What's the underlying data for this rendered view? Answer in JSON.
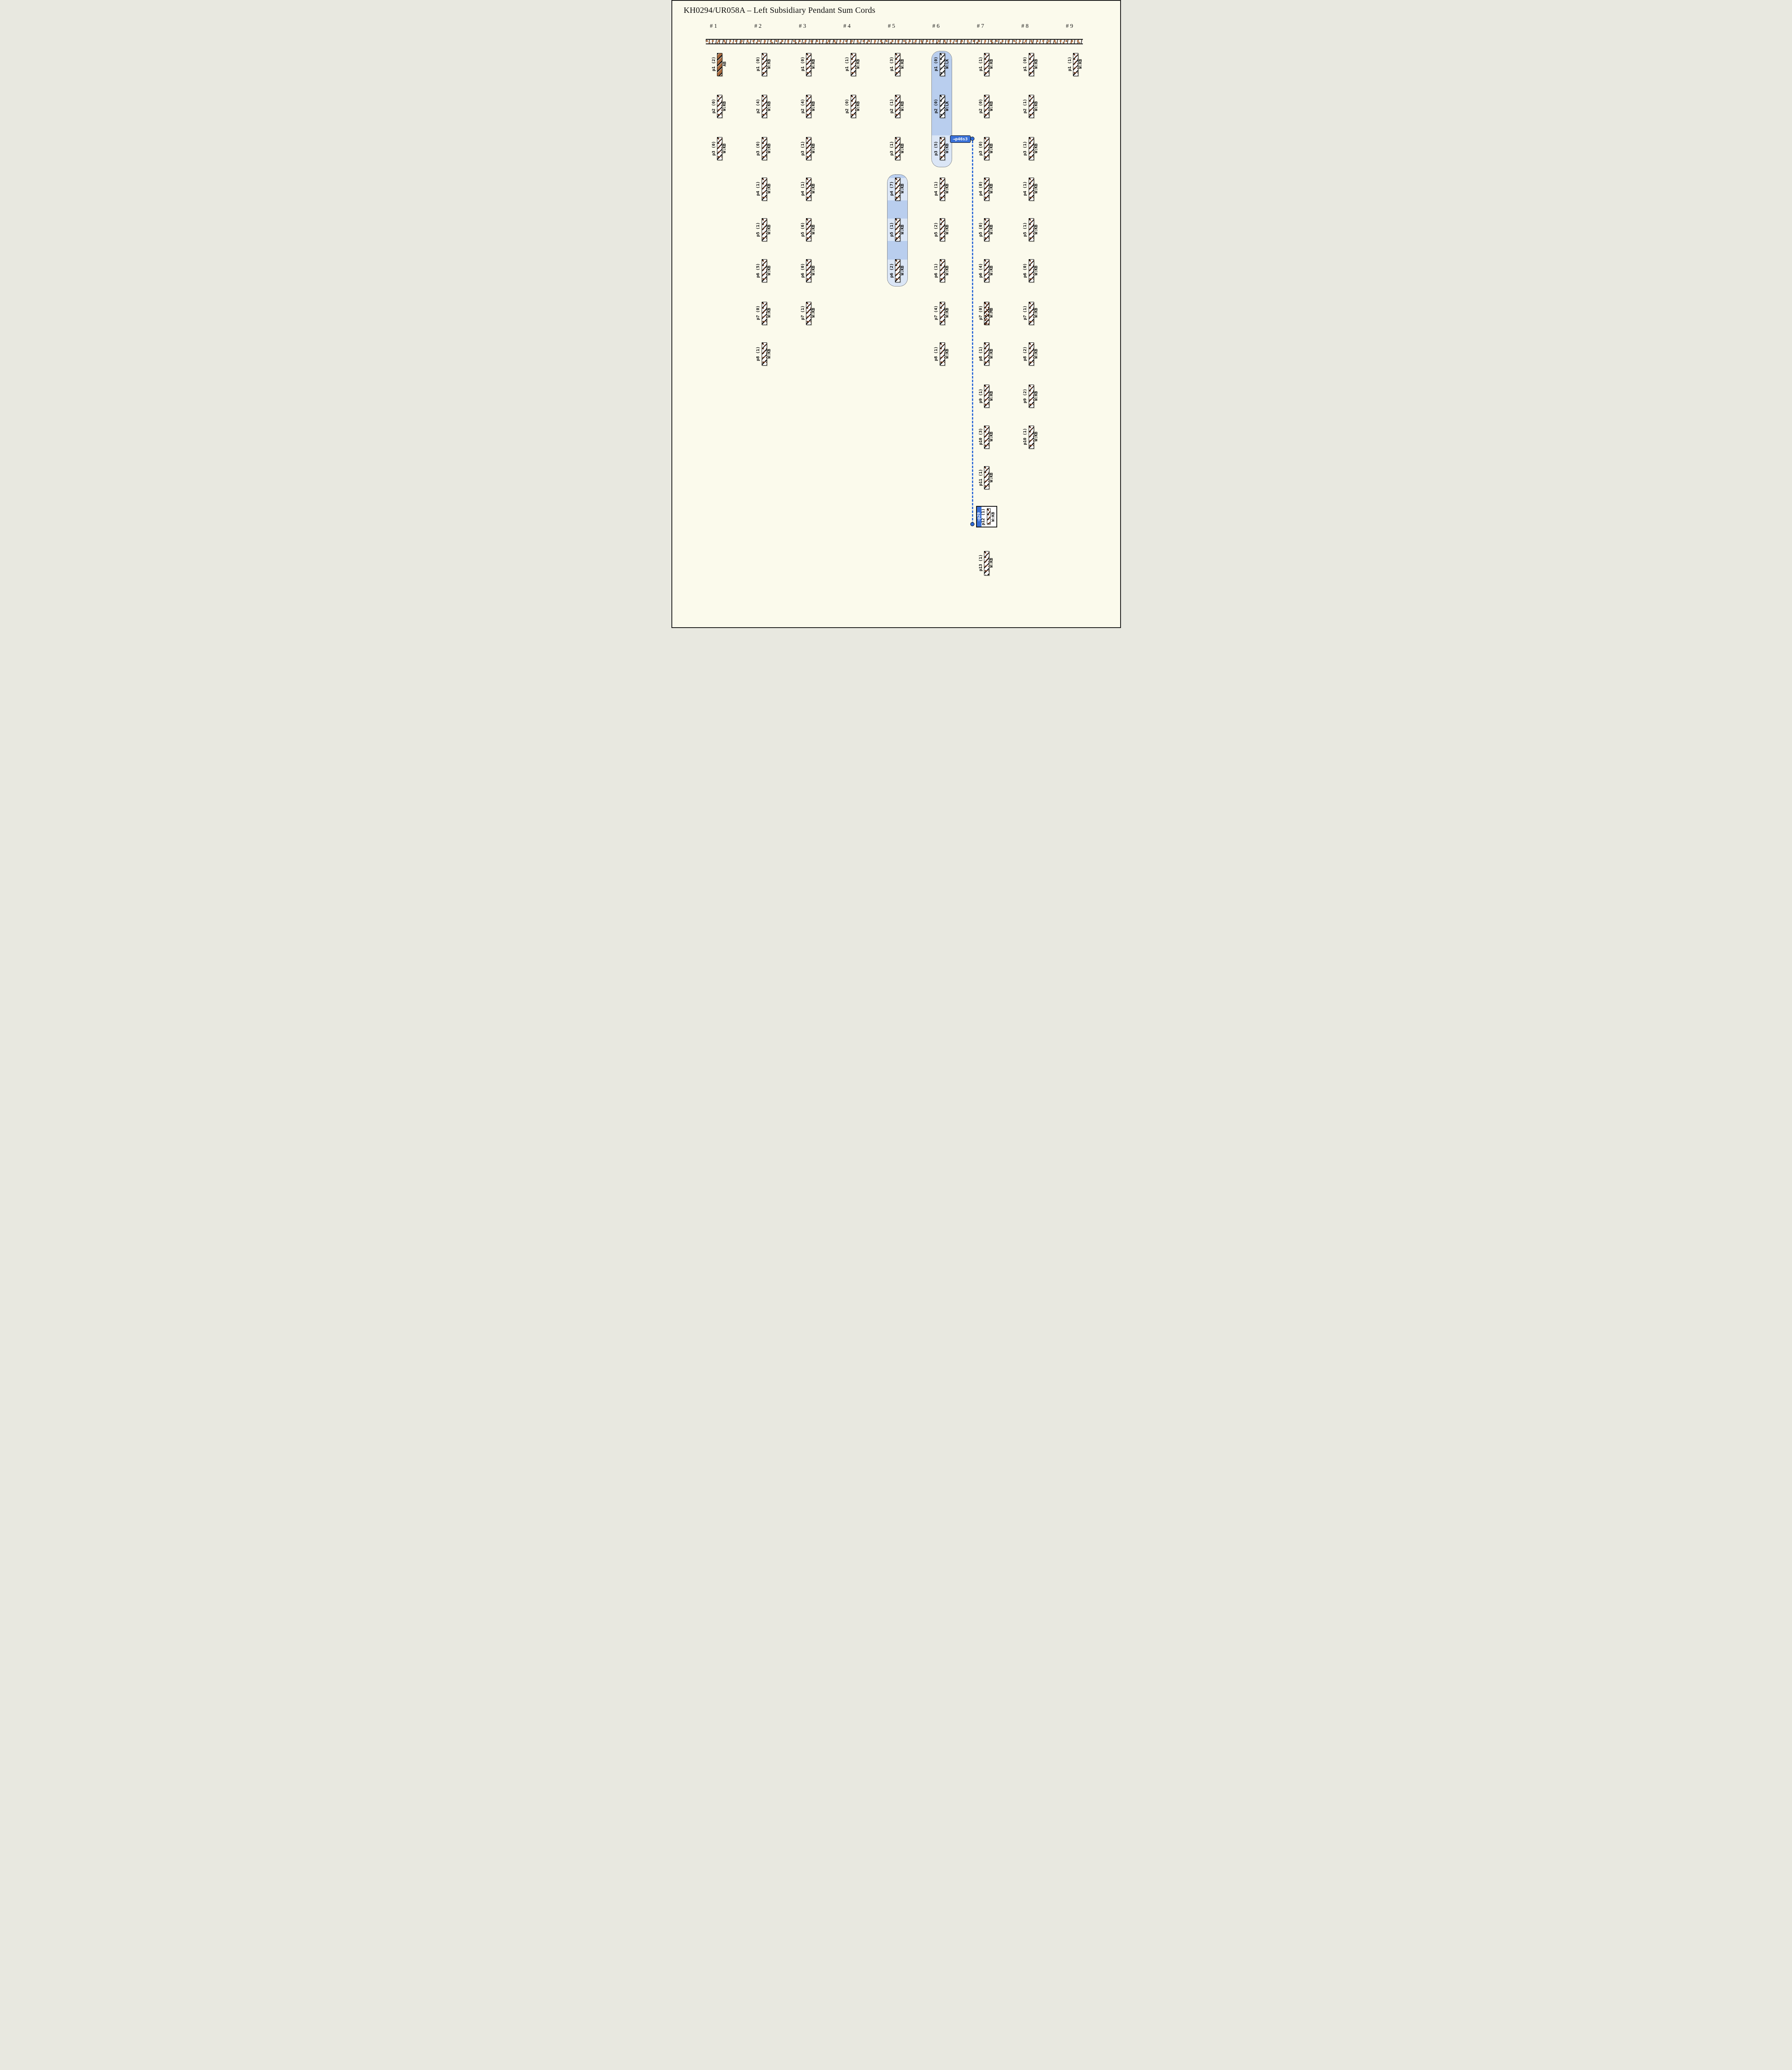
{
  "title": "KH0294/UR058A – Left Subsidiary Pendant Sum Cords",
  "headers": [
    "# 1",
    "# 2",
    "# 3",
    "# 4",
    "# 5",
    "# 6",
    "# 7",
    "# 8",
    "# 9"
  ],
  "connector": {
    "from_label": "→p46s3",
    "to_label": "→p29"
  },
  "colors": {
    "background": "#fbfaec",
    "highlight_light": "#dbe6f6",
    "highlight_dark": "#b9ceee",
    "link_blue": "#3a70d6",
    "cord_brown_AB": "#a86a3e"
  },
  "highlights": [
    {
      "column": "# 6",
      "pendants": [
        "p1",
        "p2",
        "p3"
      ]
    },
    {
      "column": "# 5",
      "pendants": [
        "p4",
        "p5",
        "p6"
      ]
    }
  ],
  "columns": [
    {
      "header": "# 1",
      "pendants": [
        {
          "row": 1,
          "label": "p1 (2)",
          "code": "AB"
        },
        {
          "row": 2,
          "label": "p2 (0)",
          "code": "W:KB"
        },
        {
          "row": 3,
          "label": "p3 (0)",
          "code": "W:KB"
        }
      ]
    },
    {
      "header": "# 2",
      "pendants": [
        {
          "row": 1,
          "label": "p1 (0)",
          "code": "W:KB"
        },
        {
          "row": 2,
          "label": "p2 (4)",
          "code": "W:KB"
        },
        {
          "row": 3,
          "label": "p3 (0)",
          "code": "W:KB"
        },
        {
          "row": 4,
          "label": "p4 (1)",
          "code": "W:KB"
        },
        {
          "row": 5,
          "label": "p5 (1)",
          "code": "W:KB"
        },
        {
          "row": 6,
          "label": "p6 (5)",
          "code": "W:KB"
        },
        {
          "row": 7,
          "label": "p7 (0)",
          "code": "W:KB"
        },
        {
          "row": 8,
          "label": "p8 (1)",
          "code": "W:KB"
        }
      ]
    },
    {
      "header": "# 3",
      "pendants": [
        {
          "row": 1,
          "label": "p1 (0)",
          "code": "W:KB"
        },
        {
          "row": 2,
          "label": "p2 (4)",
          "code": "W:KB"
        },
        {
          "row": 3,
          "label": "p3 (1)",
          "code": "W:KB"
        },
        {
          "row": 4,
          "label": "p4 (1)",
          "code": "W:KB"
        },
        {
          "row": 5,
          "label": "p5 (6)",
          "code": "W:KB"
        },
        {
          "row": 6,
          "label": "p6 (0)",
          "code": "W:KB"
        },
        {
          "row": 7,
          "label": "p7 (1)",
          "code": "W:KB"
        }
      ]
    },
    {
      "header": "# 4",
      "pendants": [
        {
          "row": 1,
          "label": "p1 (1)",
          "code": "W:KB"
        },
        {
          "row": 2,
          "label": "p2 (0)",
          "code": "W:KB"
        }
      ]
    },
    {
      "header": "# 5",
      "pendants": [
        {
          "row": 1,
          "label": "p1 (3)",
          "code": "W:KB"
        },
        {
          "row": 2,
          "label": "p2 (1)",
          "code": "W:KB"
        },
        {
          "row": 3,
          "label": "p3 (1)",
          "code": "W:KB"
        },
        {
          "row": 4,
          "label": "p4 (7)",
          "code": "W:KB",
          "highlight": true
        },
        {
          "row": 5,
          "label": "p5 (1)",
          "code": "W:KB",
          "highlight": true
        },
        {
          "row": 6,
          "label": "p6 (2)",
          "code": "W:KB",
          "highlight": true
        }
      ]
    },
    {
      "header": "# 6",
      "pendants": [
        {
          "row": 1,
          "label": "p1 (0)",
          "code": "W:LK",
          "highlight": true
        },
        {
          "row": 2,
          "label": "p2 (0)",
          "code": "W:LK",
          "highlight": true
        },
        {
          "row": 3,
          "label": "p3 (5)",
          "code": "W:KB",
          "highlight": true
        },
        {
          "row": 4,
          "label": "p4 (1)",
          "code": "W:KB"
        },
        {
          "row": 5,
          "label": "p5 (2)",
          "code": "W:KB"
        },
        {
          "row": 6,
          "label": "p6 (1)",
          "code": "W:KB"
        },
        {
          "row": 7,
          "label": "p7 (4)",
          "code": "W:KB"
        },
        {
          "row": 8,
          "label": "p8 (1)",
          "code": "W:KB"
        }
      ]
    },
    {
      "header": "# 7",
      "pendants": [
        {
          "row": 1,
          "label": "p1 (1)",
          "code": "W:KB"
        },
        {
          "row": 2,
          "label": "p2 (0)",
          "code": "W:KB"
        },
        {
          "row": 3,
          "label": "p3 (0)",
          "code": "W:KB"
        },
        {
          "row": 4,
          "label": "p4 (0)",
          "code": "W:KB"
        },
        {
          "row": 5,
          "label": "p5 (0)",
          "code": "W:KB"
        },
        {
          "row": 6,
          "label": "p6 (4)",
          "code": "W:KB"
        },
        {
          "row": 7,
          "label": "p7 (0)",
          "code": "W:MB"
        },
        {
          "row": 8,
          "label": "p8 (1)",
          "code": "W:KB"
        },
        {
          "row": 9,
          "label": "p9 (1)",
          "code": "W:KB"
        },
        {
          "row": 10,
          "label": "p10 (3)",
          "code": "W:KB"
        },
        {
          "row": 11,
          "label": "p11 (1)",
          "code": "W:KB"
        },
        {
          "row": 12,
          "label": "p12 (1)",
          "code": "W:KB",
          "boxed": true
        },
        {
          "row": 13,
          "label": "p13 (1)",
          "code": "W:KB"
        }
      ]
    },
    {
      "header": "# 8",
      "pendants": [
        {
          "row": 1,
          "label": "p1 (0)",
          "code": "W:KB"
        },
        {
          "row": 2,
          "label": "p2 (1)",
          "code": "W:KB"
        },
        {
          "row": 3,
          "label": "p3 (1)",
          "code": "W:KB"
        },
        {
          "row": 4,
          "label": "p4 (1)",
          "code": "W:KB"
        },
        {
          "row": 5,
          "label": "p5 (1)",
          "code": "W:KB"
        },
        {
          "row": 6,
          "label": "p6 (0)",
          "code": "W:KB"
        },
        {
          "row": 7,
          "label": "p7 (1)",
          "code": "W:KB"
        },
        {
          "row": 8,
          "label": "p8 (2)",
          "code": "W:KB"
        },
        {
          "row": 9,
          "label": "p9 (2)",
          "code": "W:KB"
        },
        {
          "row": 10,
          "label": "p10 (1)",
          "code": "W:KB"
        }
      ]
    },
    {
      "header": "# 9",
      "pendants": [
        {
          "row": 1,
          "label": "p1 (1)",
          "code": "W:KB"
        }
      ]
    }
  ]
}
